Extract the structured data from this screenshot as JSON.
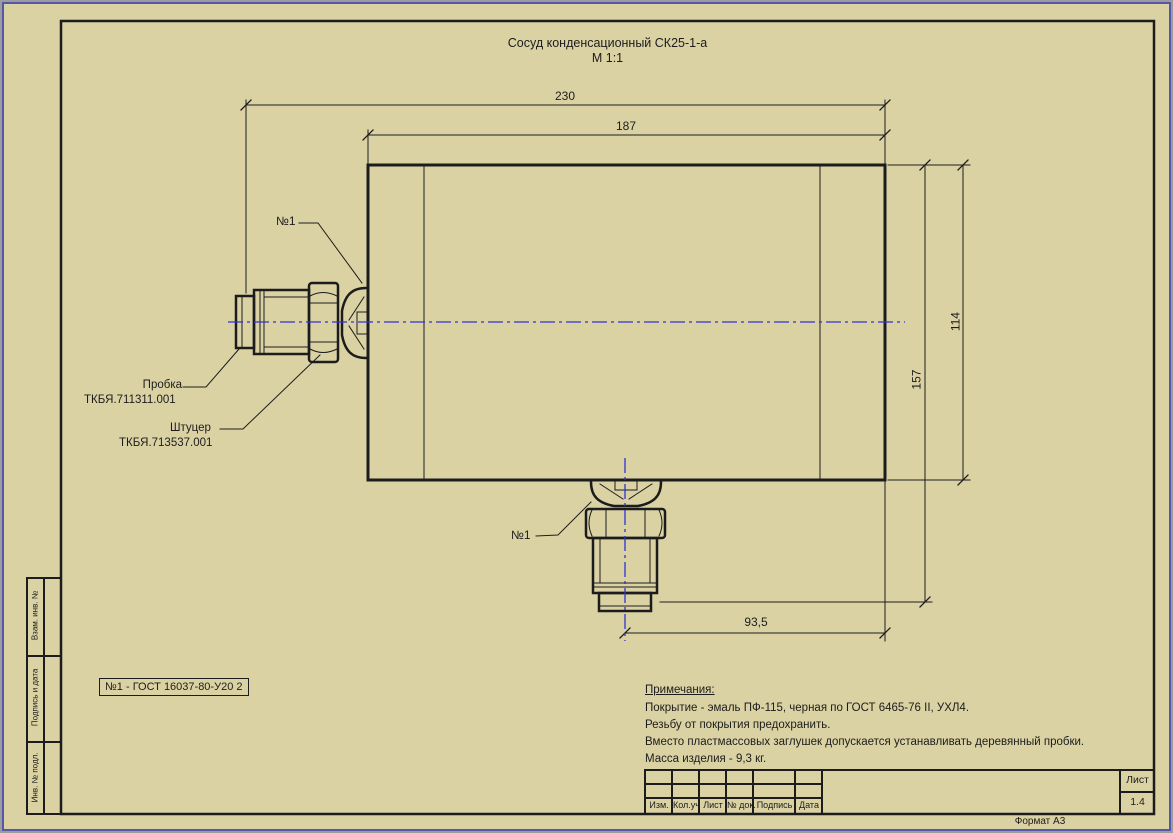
{
  "title": {
    "line1": "Сосуд конденсационный СК25-1-а",
    "line2": "М 1:1"
  },
  "dims": {
    "d230": "230",
    "d187": "187",
    "d114": "114",
    "d157": "157",
    "d93_5": "93,5"
  },
  "callouts": {
    "no1": "№1",
    "probka_name": "Пробка",
    "probka_code": "ТКБЯ.711311.001",
    "shtutser_name": "Штуцер",
    "shtutser_code": "ТКБЯ.713537.001"
  },
  "note_box": {
    "text": "№1 - ГОСТ 16037-80-У20 2"
  },
  "notes": {
    "heading": "Примечания:",
    "items": [
      "Покрытие - эмаль ПФ-115, черная по ГОСТ 6465-76 II, УХЛ4.",
      "Резьбу от покрытия предохранить.",
      "Вместо пластмассовых заглушек допускается устанавливать деревянный пробки.",
      "Масса изделия - 9,3 кг."
    ]
  },
  "title_block": {
    "columns": [
      "Изм.",
      "Кол.уч",
      "Лист",
      "№ док.",
      "Подпись",
      "Дата"
    ],
    "sheet_label": "Лист",
    "sheet_value": "1.4",
    "format_label": "Формат А3"
  },
  "sidebar": {
    "items": [
      "Взам. инв. №",
      "Подпись и дата",
      "Инв. № подл."
    ]
  },
  "colors": {
    "paper": "#dbd2a4",
    "line": "#1c1c1c",
    "centerline": "#2f32d2",
    "outer_border": "#5457ab"
  }
}
